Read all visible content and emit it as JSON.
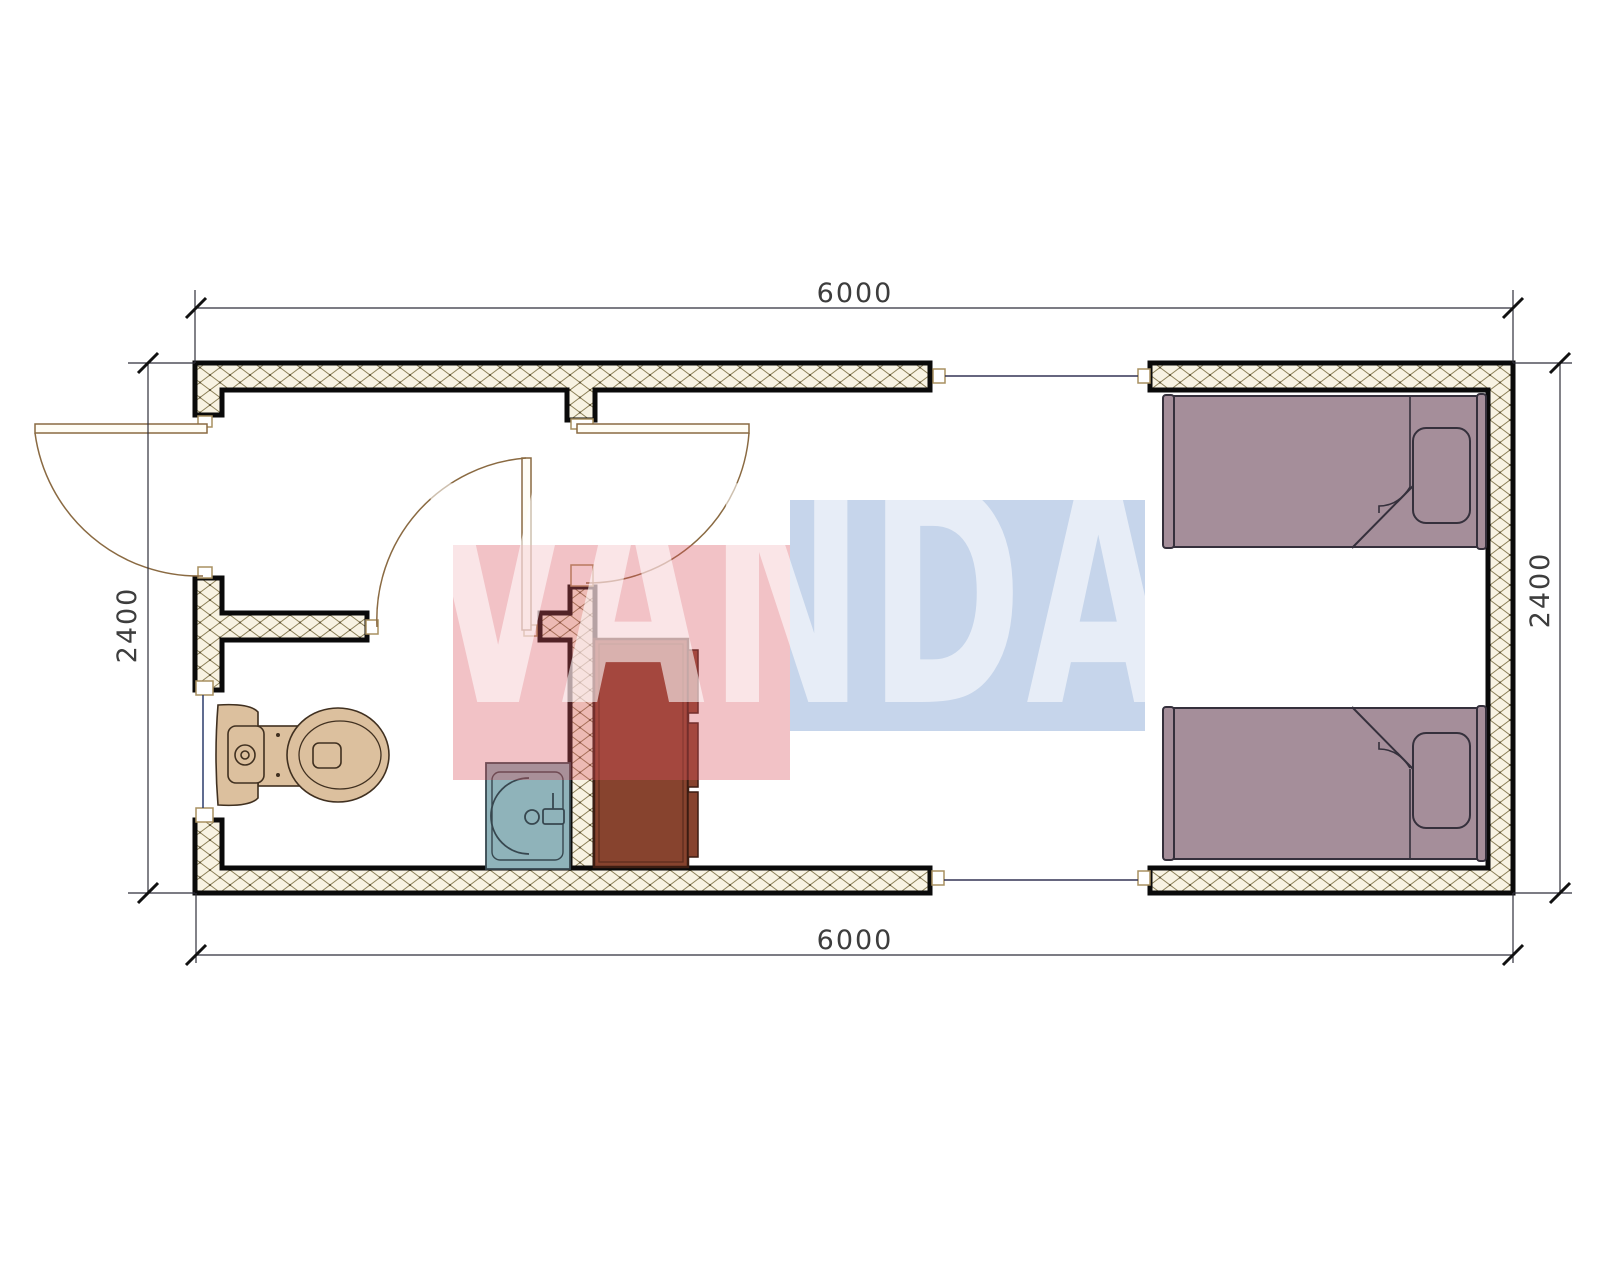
{
  "plan": {
    "dimensions": {
      "top": "6000",
      "bottom": "6000",
      "left": "2400",
      "right": "2400"
    },
    "watermark": {
      "text": "VANDA",
      "red": "#d94f5c",
      "blue": "#5b87c5"
    },
    "colors": {
      "wall_outline": "#0a0a0a",
      "hatch_bg": "#f8f3e3",
      "hatch_line": "#8d8158",
      "dimension_line": "#2f2f3a",
      "tick": "#111111",
      "door": "#8a6a42",
      "toilet": "#dcc09e",
      "toilet_stroke": "#403020",
      "sink": "#8fb3ba",
      "sink_stroke": "#37474f",
      "cabinet": "#87432e",
      "cabinet_stroke": "#3c1d12",
      "bed": "#a58e9a",
      "bed_stroke": "#35303c",
      "window_glass": "#2b3a6b",
      "joint_line": "#333355",
      "jamb_stroke": "#a89060"
    },
    "fixtures": {
      "toilet": "toilet",
      "sink": "wash-basin",
      "cabinet": "wardrobe-cabinet",
      "bed_top": "single-bed",
      "bed_bottom": "single-bed",
      "entry_door": "entry-door",
      "partition_door": "partition-door",
      "wc_door": "wc-door",
      "window": "window"
    }
  }
}
